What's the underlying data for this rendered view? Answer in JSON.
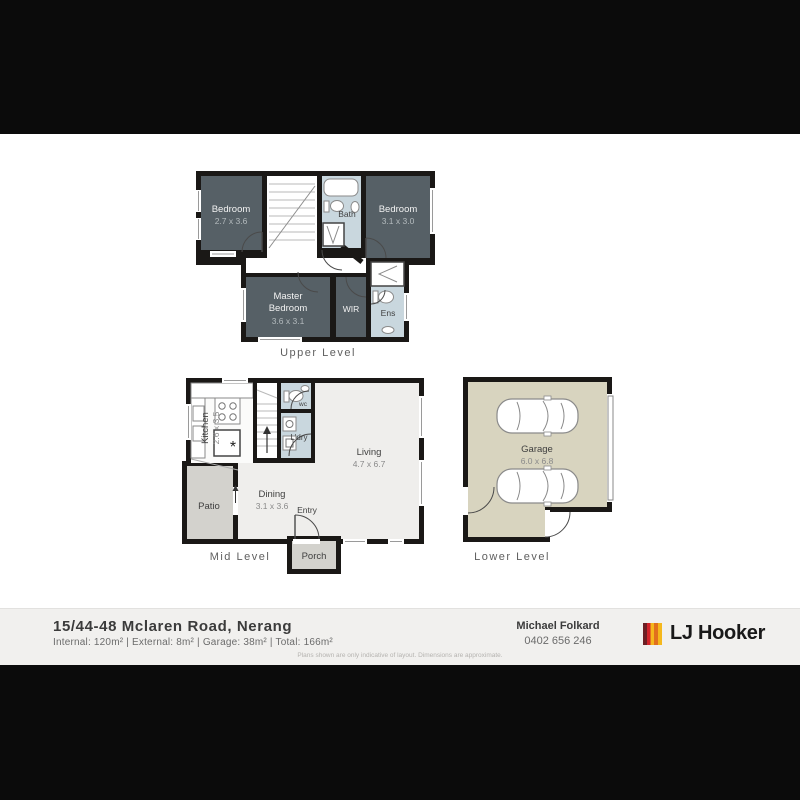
{
  "levels": {
    "upper": {
      "label": "Upper Level",
      "rooms": {
        "bedroom1": {
          "name": "Bedroom",
          "dims": "2.7 x 3.6"
        },
        "bedroom2": {
          "name": "Bedroom",
          "dims": "3.1 x 3.0"
        },
        "master": {
          "line1": "Master",
          "line2": "Bedroom",
          "dims": "3.6 x 3.1"
        },
        "bath": {
          "name": "Bath"
        },
        "wir": {
          "name": "WIR"
        },
        "ens": {
          "name": "Ens"
        }
      }
    },
    "mid": {
      "label": "Mid Level",
      "rooms": {
        "kitchen": {
          "name": "Kitchen",
          "dims": "2.6 x 3.5",
          "symbol": "*"
        },
        "wc": {
          "name": "wc"
        },
        "laundry": {
          "name": "L'dry"
        },
        "living": {
          "name": "Living",
          "dims": "4.7 x 6.7"
        },
        "dining": {
          "name": "Dining",
          "dims": "3.1 x 3.6"
        },
        "entry": {
          "name": "Entry"
        },
        "patio": {
          "name": "Patio"
        },
        "porch": {
          "name": "Porch"
        }
      }
    },
    "lower": {
      "label": "Lower Level",
      "rooms": {
        "garage": {
          "name": "Garage",
          "dims": "6.0 x 6.8"
        }
      }
    }
  },
  "footer": {
    "address": "15/44-48 Mclaren Road, Nerang",
    "details": "Internal: 120m² | External: 8m² | Garage: 38m² | Total: 166m²",
    "agent_name": "Michael Folkard",
    "agent_phone": "0402 656 246",
    "brand": "LJ Hooker",
    "disclaimer": "Plans shown are only indicative of layout. Dimensions are approximate."
  },
  "colors": {
    "wall": "#1a1816",
    "bedroom_fill": "#566066",
    "wet_area_fill": "#c9d7de",
    "floor_fill": "#efeeec",
    "garage_fill": "#d8d4bf",
    "outdoor_fill": "#d3d2cd",
    "brand_maroon": "#6d1f24",
    "brand_red": "#d2232a",
    "brand_yellow": "#f5b81c",
    "brand_orange": "#e1701d"
  }
}
